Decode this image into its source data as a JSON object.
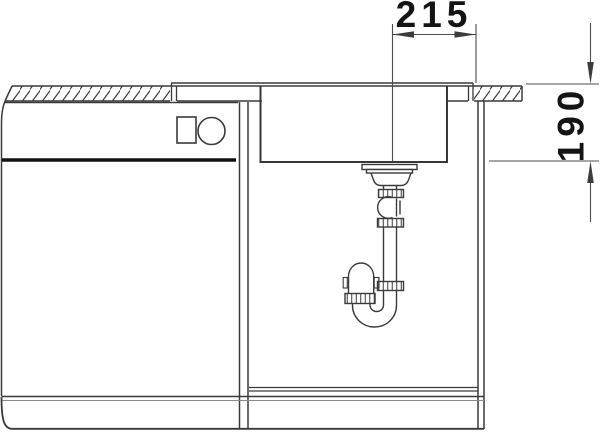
{
  "drawing": {
    "width_dimension": "215",
    "depth_dimension": "190",
    "colors": {
      "line": "#3a3a3a",
      "dimension_line": "#4c4c4c",
      "text": "#141414",
      "thick_panel_line": "#101010",
      "background": "#ffffff"
    }
  }
}
